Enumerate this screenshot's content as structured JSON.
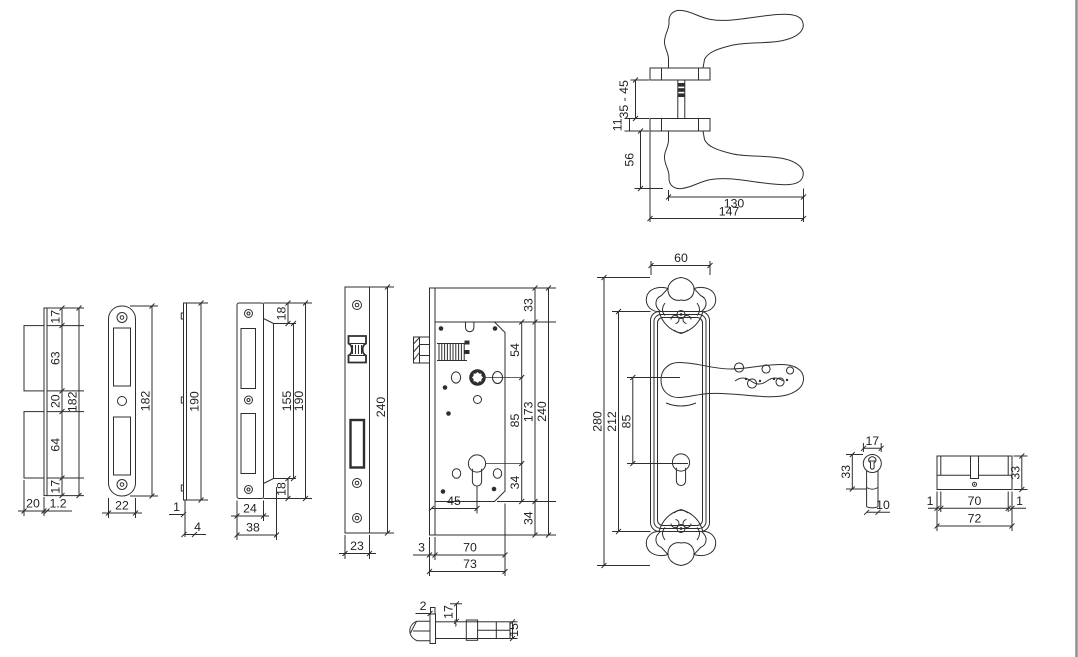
{
  "meta": {
    "background": "#ffffff",
    "line_color": "#2e2e2e",
    "text_color": "#1f1f1f",
    "border_color": "#8f8f8f",
    "drawing_type": "door lock hardware technical drawing"
  },
  "parts": {
    "handle_pair_side_view": {
      "grip_span": "35 - 45",
      "rose_thickness": "11",
      "lever_drop": "56",
      "lever_length": "130",
      "overall_length": "147"
    },
    "box_strike_side_view": {
      "top_margin": "17",
      "upper_box": "63",
      "middle_gap": "20",
      "lower_box": "64",
      "bottom_margin": "17",
      "overall_height": "182",
      "box_depth": "20",
      "plate_thickness": "1.2"
    },
    "strike_plate_front_view": {
      "overall_height": "182",
      "width": "22"
    },
    "strike_plate_profile_view": {
      "height": "190",
      "thickness": "1",
      "depth": "4"
    },
    "lipped_strike_front_view": {
      "top_offset": "18",
      "lip_height": "155",
      "overall_height": "190",
      "bottom_offset": "18",
      "plate_width": "24",
      "overall_width": "38"
    },
    "faceplate_front_view": {
      "height": "240",
      "width": "23"
    },
    "lock_case_view": {
      "top_margin": "33",
      "top_to_hub": "54",
      "hub_to_cylinder": "85",
      "case_height": "173",
      "overall_height": "240",
      "cylinder_to_case_bottom": "34",
      "bottom_margin": "34",
      "backset": "45",
      "faceplate_thickness": "3",
      "case_depth": "70",
      "overall_depth": "73"
    },
    "backplate_with_lever_view": {
      "plate_width": "60",
      "overall_height": "280",
      "plate_height": "212",
      "hub_to_cylinder": "85"
    },
    "cylinder_end_view": {
      "width": "17",
      "profile_height": "33",
      "body_width": "10"
    },
    "cylinder_side_view": {
      "height": "33",
      "left_margin": "1",
      "pin_length": "70",
      "right_margin": "1",
      "overall_length": "72"
    },
    "latch_bolt_side_view": {
      "plate_thickness": "2",
      "head_height": "17",
      "body_height": "15"
    }
  }
}
